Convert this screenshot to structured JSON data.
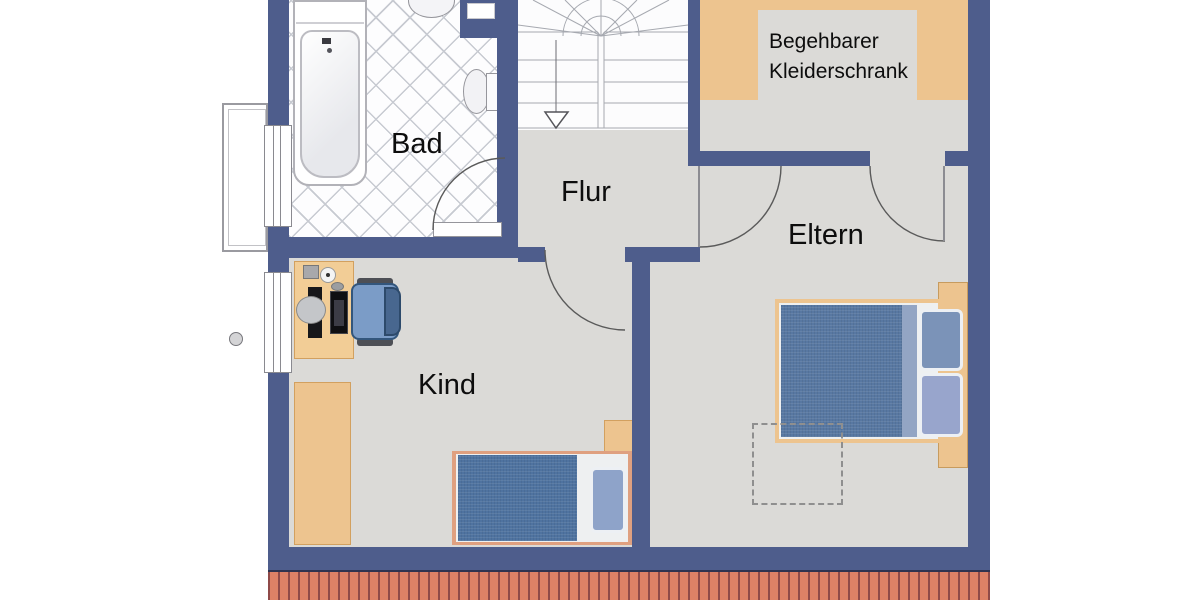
{
  "plan": {
    "title": "Obergeschoss Grundriss (floor plan)"
  },
  "rooms": {
    "bad": {
      "label": "Bad"
    },
    "flur": {
      "label": "Flur"
    },
    "eltern": {
      "label": "Eltern"
    },
    "kind": {
      "label": "Kind"
    },
    "kleiderschrank": {
      "label_line1": "Begehbarer",
      "label_line2": "Kleiderschrank"
    }
  },
  "furniture": {
    "bad": [
      "bathtub",
      "washbasin",
      "toilet"
    ],
    "flur": [
      "staircase-with-down-arrow"
    ],
    "kleiderschrank": [
      "u-shaped-wardrobe-shelving"
    ],
    "kind": [
      "desk",
      "computer-monitor",
      "keyboard",
      "office-chair",
      "wardrobe",
      "single-bed",
      "nightstand"
    ],
    "eltern": [
      "double-bed",
      "two-pillows",
      "dashed-planning-area",
      "walk-in-closet-door"
    ]
  },
  "exterior": [
    "left-facade-windows",
    "balcony-outline",
    "rain-pipe",
    "roof-edge-shingles"
  ],
  "colors": {
    "wall": "#4e5d8c",
    "floor": "#dbdad7",
    "tile-line": "#c7cad1",
    "wood": "#edc48f",
    "wood-border": "#d2a05f",
    "roof": "#dd8166",
    "roof-line": "#8f4a48",
    "blanket": "#5878a2",
    "blanket-kind": "#4f73a0",
    "pillow": "#8ea3c9",
    "sheet": "#eef0f1",
    "bedframe": "#dfa080",
    "stair-line": "#a6a9b0",
    "door-arc": "#5a5a5a"
  }
}
